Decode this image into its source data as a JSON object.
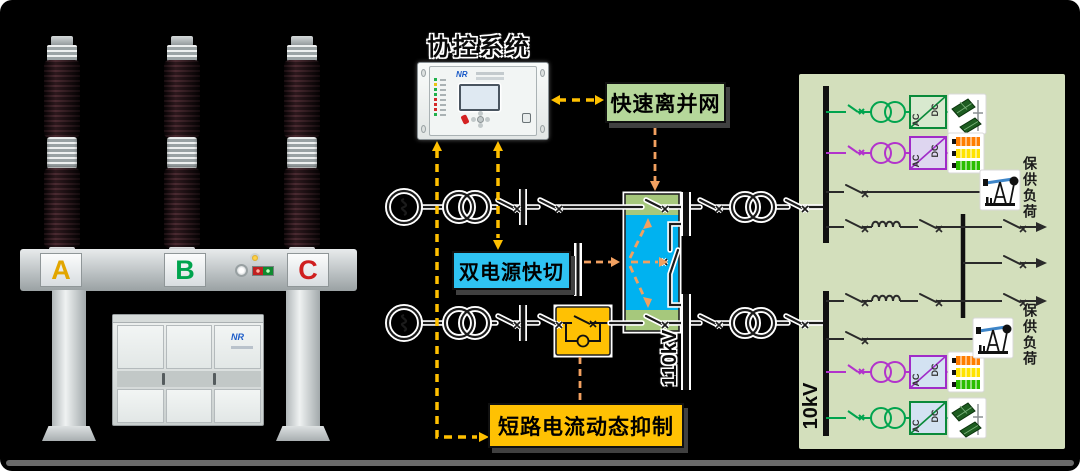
{
  "canvas": {
    "background": "#000000",
    "floor_color": "#666666"
  },
  "breaker_photo": {
    "phases": [
      {
        "label": "A",
        "color": "#e2a600"
      },
      {
        "label": "B",
        "color": "#00a44e"
      },
      {
        "label": "C",
        "color": "#cf1f1f"
      }
    ],
    "cabinet_logo": "NR"
  },
  "control_system": {
    "title": "协控系统",
    "device_logo": "NR"
  },
  "function_boxes": {
    "fast_island": {
      "label": "快速离并网",
      "bg": "#b5d79a"
    },
    "dual_source": {
      "label": "双电源快切",
      "bg": "#2fc3f2"
    },
    "short_circuit_suppress": {
      "label": "短路电流动态抑制",
      "bg": "#ffc103"
    }
  },
  "diagram_labels": {
    "bus_110kv": "110kV",
    "bus_10kv": "10kV",
    "guaranteed_load_top": "保供负荷",
    "guaranteed_load_bottom": "保供负荷",
    "ac": "AC",
    "dc": "DC"
  },
  "accent_colors": {
    "dashed_signal_gold": "#ffc000",
    "dashed_signal_orange": "#f2a060",
    "panel_green": "#d3dfbc",
    "transfer_cyan": "#00b2f0",
    "transfer_strip_green": "#a6c87c",
    "solar_branch_green": "#00a44e",
    "storage_branch_purple": "#b233cc"
  }
}
